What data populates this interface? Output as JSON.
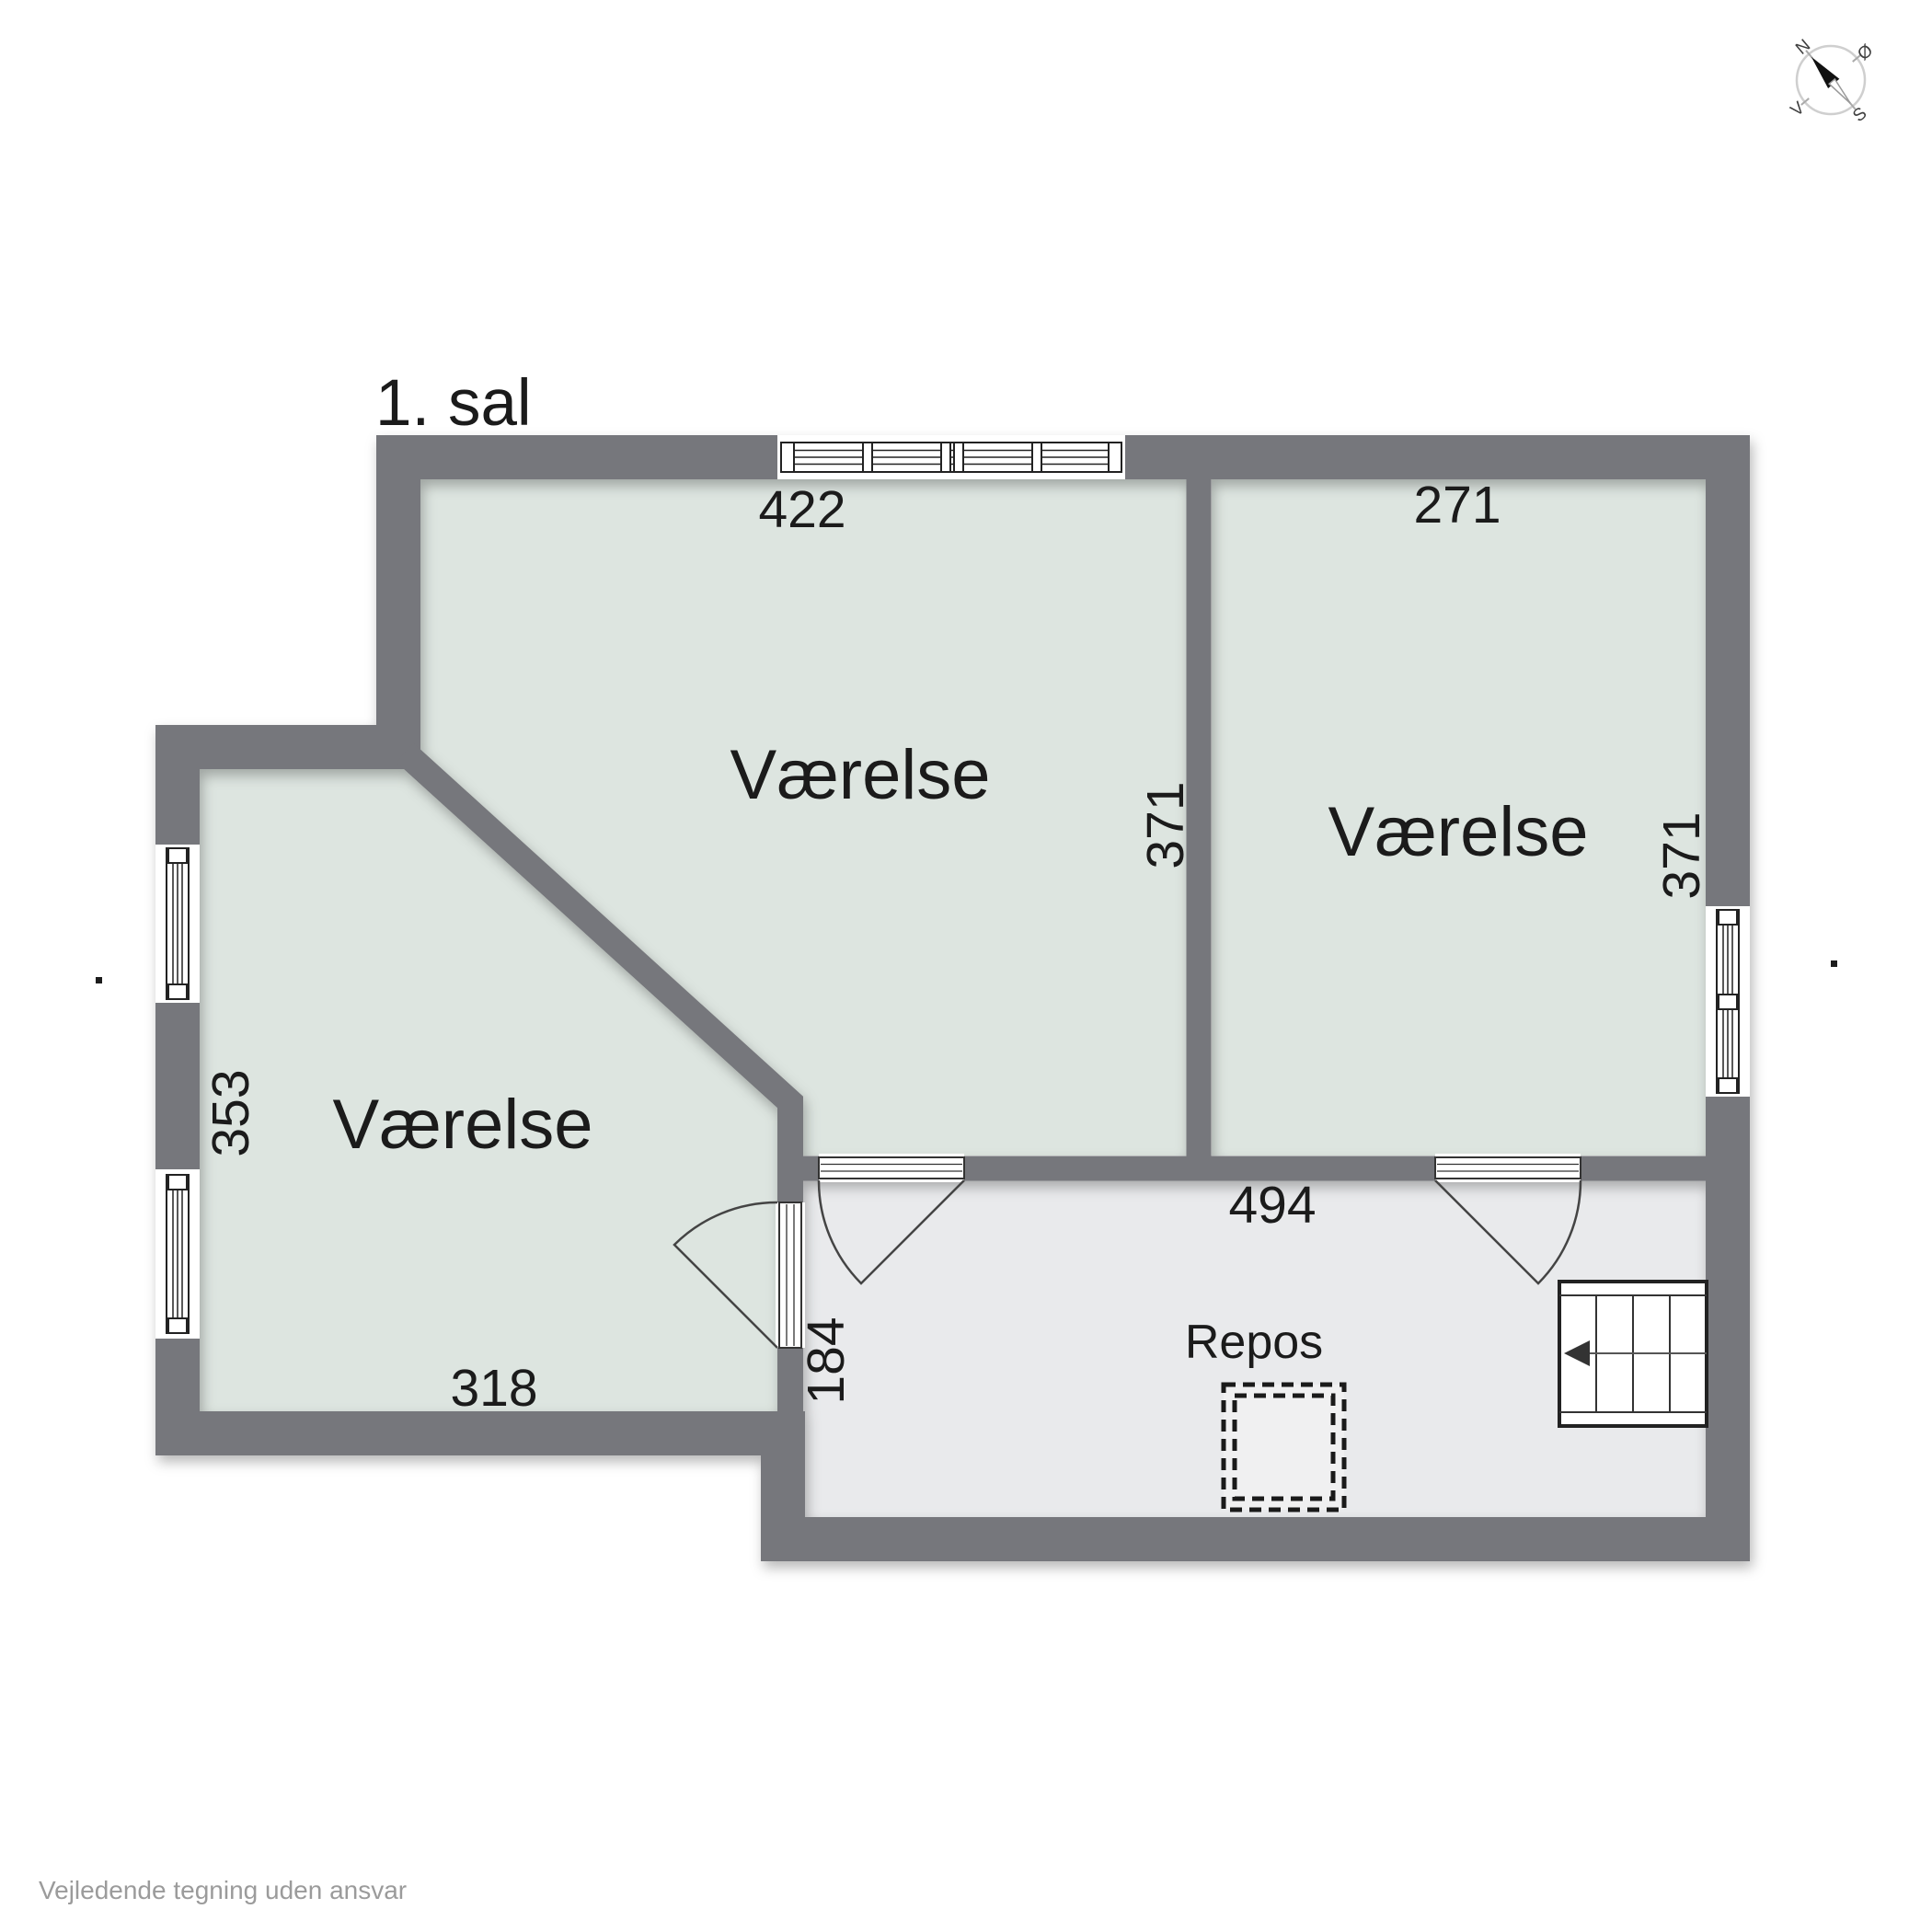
{
  "title": "1. sal",
  "disclaimer": "Vejledende tegning uden ansvar",
  "compass": {
    "north": "N",
    "east": "Ø",
    "south": "S",
    "west": "V"
  },
  "rooms": {
    "middle": {
      "label": "Værelse",
      "width_label": "422",
      "depth_label": "371"
    },
    "right": {
      "label": "Værelse",
      "width_label": "271",
      "depth_label": "371"
    },
    "left": {
      "label": "Værelse",
      "width_label": "318",
      "depth_label": "353"
    },
    "landing": {
      "label": "Repos",
      "width_label": "494",
      "passage_label": "184"
    }
  },
  "colors": {
    "wall": "#76777b",
    "room_fill": "#dde5e0",
    "landing_fill": "#e9eaec",
    "chimney_fill": "#f0f0f1",
    "outline": "#222222",
    "text": "#1b1b1b",
    "muted_text": "#9b9b9b"
  }
}
